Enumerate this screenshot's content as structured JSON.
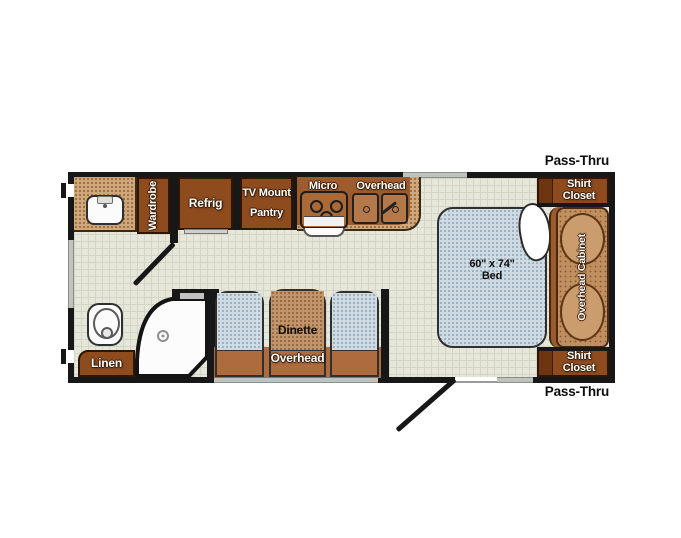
{
  "floorplan": {
    "pass_thru_top": "Pass-Thru",
    "pass_thru_bottom": "Pass-Thru",
    "kitchen": {
      "wardrobe": "Wardrobe",
      "refrig": "Refrig",
      "tv_mount": "TV Mount",
      "pantry": "Pantry",
      "micro": "Micro",
      "overhead": "Overhead"
    },
    "bedroom": {
      "bed_size": "60\" x 74\"",
      "bed": "Bed",
      "overhead_cabinet": "Overhead Cabinet",
      "shirt_closet_top": "Shirt Closet",
      "shirt_closet_bottom": "Shirt Closet"
    },
    "dinette": {
      "label": "Dinette",
      "overhead": "Overhead"
    },
    "bathroom": {
      "linen": "Linen"
    },
    "colors": {
      "wall": "#171717",
      "floor": "#e6e7da",
      "cabinet_brown": "#8d4b1e",
      "cabinet_light_brown": "#ad6b3e",
      "counter_tan": "#cfa77a",
      "cushion_blue": "#cfdbe3",
      "table_tan": "#c3946a",
      "overhead_cabinet_tan": "#bf8f60",
      "window_gray": "#bfc3bd",
      "label_white": "#ffffff",
      "label_black": "#0d0d0d"
    }
  }
}
